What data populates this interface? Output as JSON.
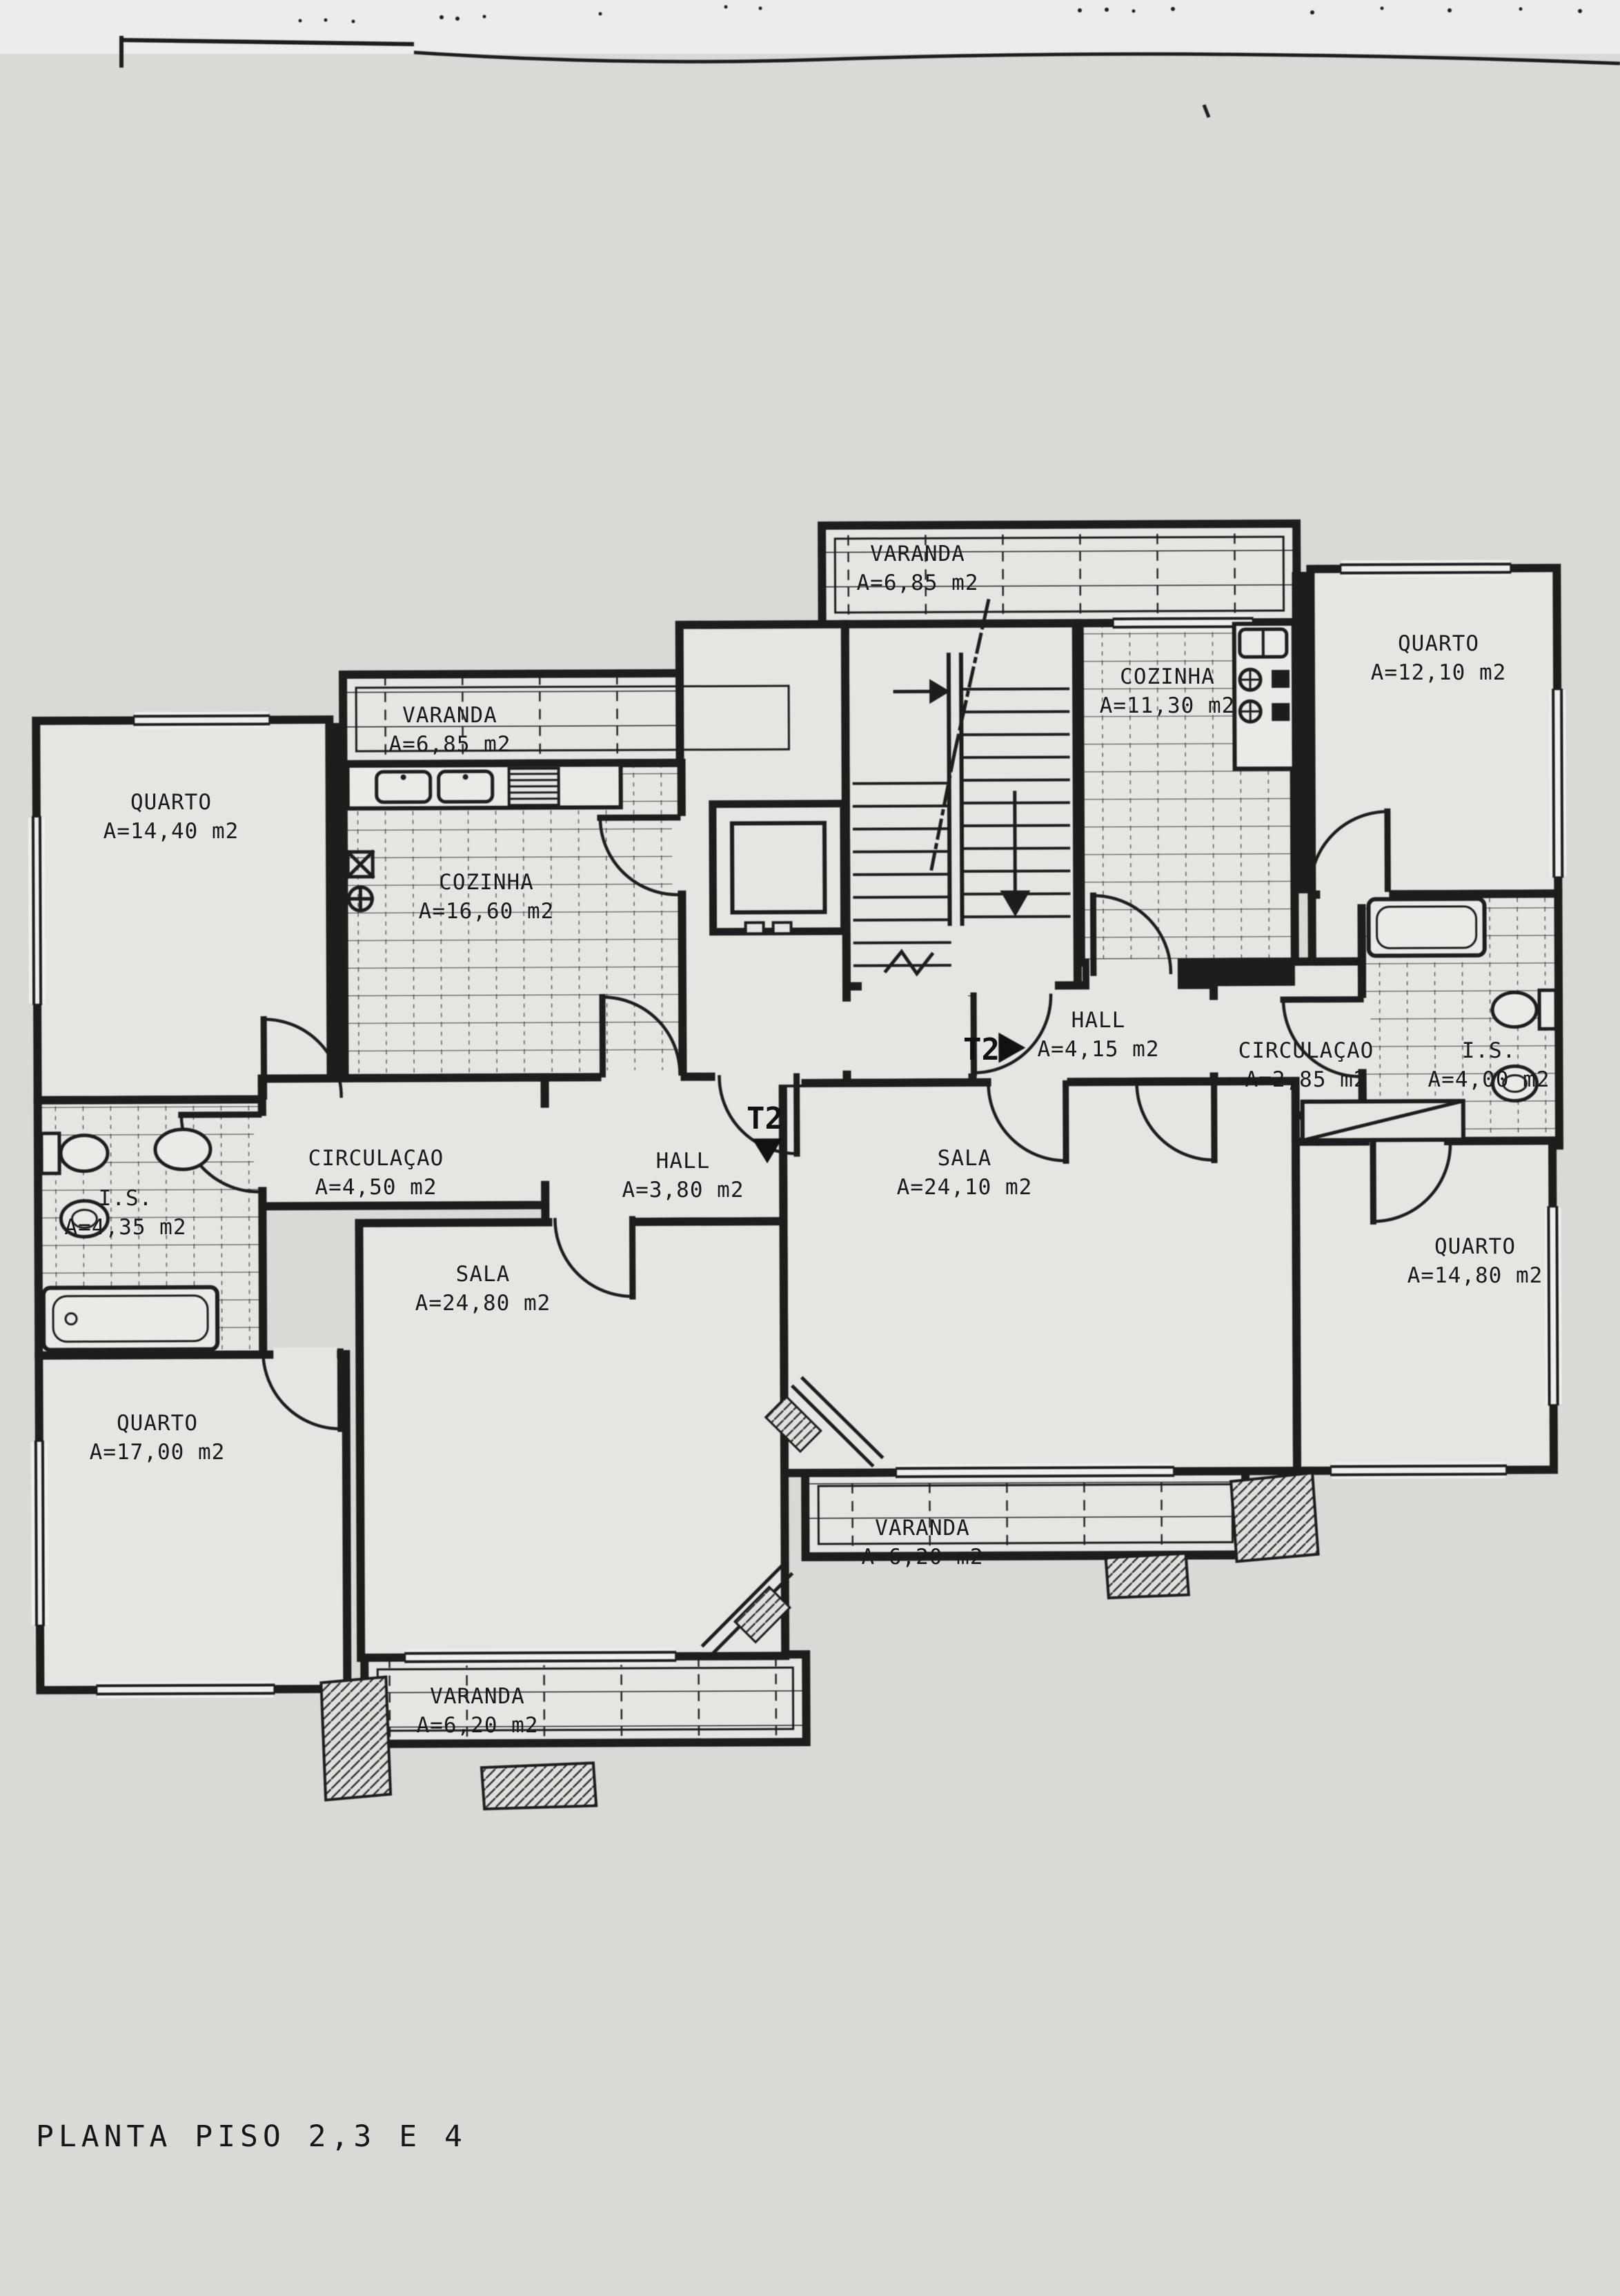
{
  "title": "PLANTA PISO 2,3 E 4",
  "colors": {
    "ink": "#1d1d1d",
    "paper": "#dbd9d5",
    "room": "#e7e5e1"
  },
  "markers": {
    "t2_right": {
      "label": "T2",
      "arrow": "▶"
    },
    "t2_left": {
      "label": "T2",
      "arrow": "▼"
    }
  },
  "rooms": {
    "varanda_top": {
      "name": "VARANDA",
      "area": "A=6,85 m2"
    },
    "quarto_ne": {
      "name": "QUARTO",
      "area": "A=12,10 m2"
    },
    "cozinha_right": {
      "name": "COZINHA",
      "area": "A=11,30 m2"
    },
    "varanda_left": {
      "name": "VARANDA",
      "area": "A=6,85 m2"
    },
    "quarto_nw": {
      "name": "QUARTO",
      "area": "A=14,40 m2"
    },
    "cozinha_left": {
      "name": "COZINHA",
      "area": "A=16,60 m2"
    },
    "hall_right": {
      "name": "HALL",
      "area": "A=4,15 m2"
    },
    "circulacao_right": {
      "name": "CIRCULAÇAO",
      "area": "A=2,85 m2"
    },
    "is_right": {
      "name": "I.S.",
      "area": "A=4,00 m2"
    },
    "circulacao_left": {
      "name": "CIRCULAÇAO",
      "area": "A=4,50 m2"
    },
    "hall_left": {
      "name": "HALL",
      "area": "A=3,80 m2"
    },
    "sala_right": {
      "name": "SALA",
      "area": "A=24,10 m2"
    },
    "is_left": {
      "name": "I.S.",
      "area": "A=4,35 m2"
    },
    "sala_left": {
      "name": "SALA",
      "area": "A=24,80 m2"
    },
    "quarto_se": {
      "name": "QUARTO",
      "area": "A=14,80 m2"
    },
    "quarto_sw": {
      "name": "QUARTO",
      "area": "A=17,00 m2"
    },
    "varanda_mid": {
      "name": "VARANDA",
      "area": "A=6,20 m2"
    },
    "varanda_bottom": {
      "name": "VARANDA",
      "area": "A=6,20 m2"
    }
  }
}
